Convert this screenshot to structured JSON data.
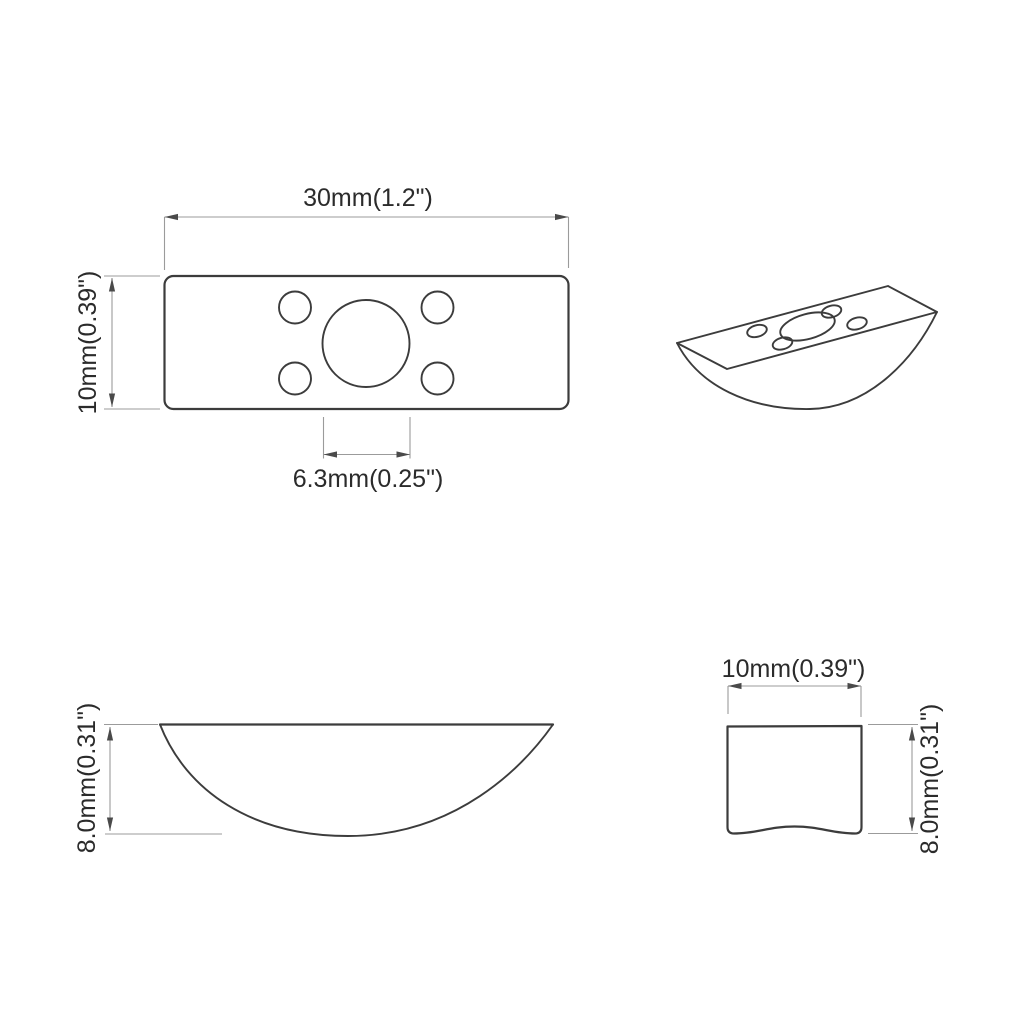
{
  "colors": {
    "background": "#ffffff",
    "outline": "#3c3c3c",
    "dimension_lines": "#9b9b9b",
    "text": "#2b2b2b"
  },
  "views": {
    "top": {
      "width_label": "30mm(1.2\")",
      "height_label": "10mm(0.39\")",
      "center_hole_label": "6.3mm(0.25\")"
    },
    "side": {
      "height_label": "8.0mm(0.31\")"
    },
    "end": {
      "width_label": "10mm(0.39\")",
      "height_label": "8.0mm(0.31\")"
    }
  }
}
